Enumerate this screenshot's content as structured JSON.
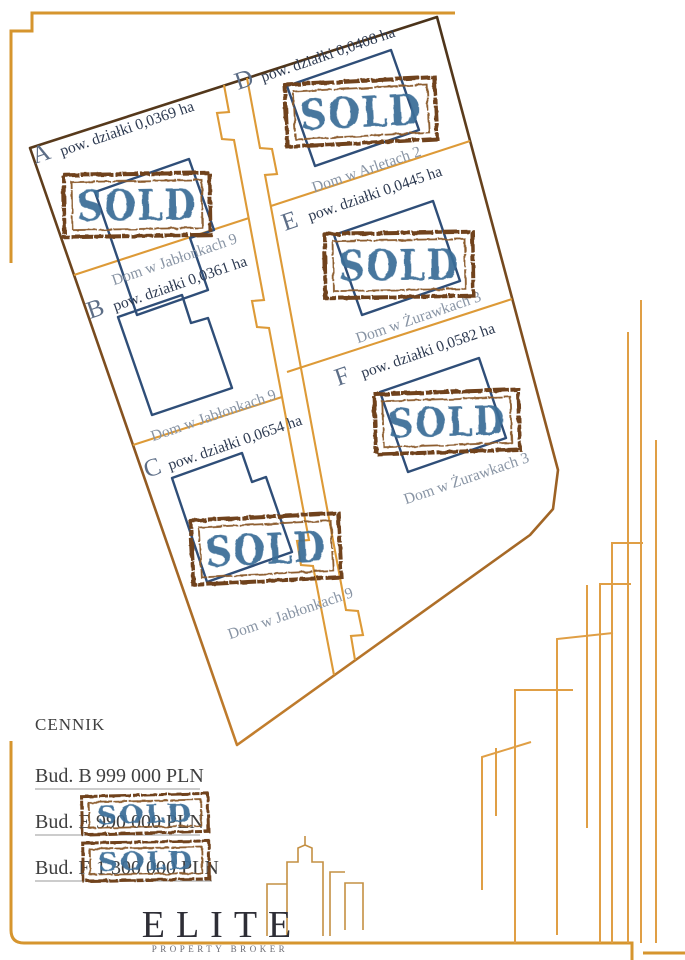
{
  "map": {
    "sold_stamp_text": "SOLD",
    "plots": [
      {
        "id": "A",
        "area_label": "pow. działki 0,0369 ha",
        "address": "Dom w Jabłonkach 9",
        "sold": true
      },
      {
        "id": "B",
        "area_label": "pow. działki 0,0361 ha",
        "address": "Dom w Jabłonkach 9",
        "sold": false
      },
      {
        "id": "C",
        "area_label": "pow. działki 0,0654 ha",
        "address": "Dom w Jabłonkach 9",
        "sold": true
      },
      {
        "id": "D",
        "area_label": "pow. działki 0,0408 ha",
        "address": "Dom w Arletach 2",
        "sold": true
      },
      {
        "id": "E",
        "area_label": "pow. działki 0,0445 ha",
        "address": "Dom w Żurawkach 3",
        "sold": true
      },
      {
        "id": "F",
        "area_label": "pow. działki 0,0582 ha",
        "address": "Dom w Żurawkach 3",
        "sold": true
      }
    ]
  },
  "price_list": {
    "title": "CENNIK",
    "rows": [
      {
        "label": "Bud. B",
        "price": "999 000 PLN",
        "sold": false
      },
      {
        "label": "Bud. E",
        "price": "990 000 PLN",
        "sold": true
      },
      {
        "label": "Bud. F",
        "price": "1 300 000 PLN",
        "sold": true
      }
    ]
  },
  "logo": {
    "name": "ELITE",
    "tagline": "PROPERTY BROKER"
  },
  "colors": {
    "boundary_brown_dark": "#45301a",
    "boundary_brown_light": "#c8822e",
    "line_orange": "#dd9a37",
    "house_navy": "#2f4e78",
    "stamp_blue": "#3c6d97",
    "stamp_brown": "#6f431c",
    "plot_letter_blue": "#5d6e87",
    "area_text_navy": "#2c3950",
    "address_gray": "#8894a4",
    "logo_dark": "#2e2e36",
    "gold": "#c49043"
  }
}
